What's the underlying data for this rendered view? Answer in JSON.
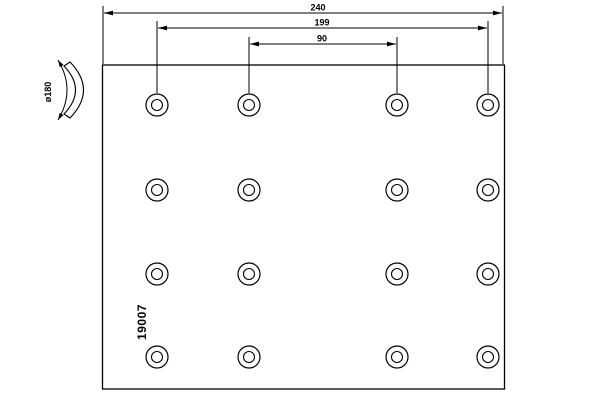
{
  "drawing": {
    "part_number": "19007",
    "dimensions": {
      "overall_length": "240",
      "outer_rivet_span": "199",
      "inner_rivet_span": "90",
      "curve_diameter": "ø180"
    },
    "rivet_holes": {
      "rows": 4,
      "columns": 4,
      "total": 16
    },
    "colors": {
      "line": "#000000",
      "background": "#ffffff"
    }
  }
}
